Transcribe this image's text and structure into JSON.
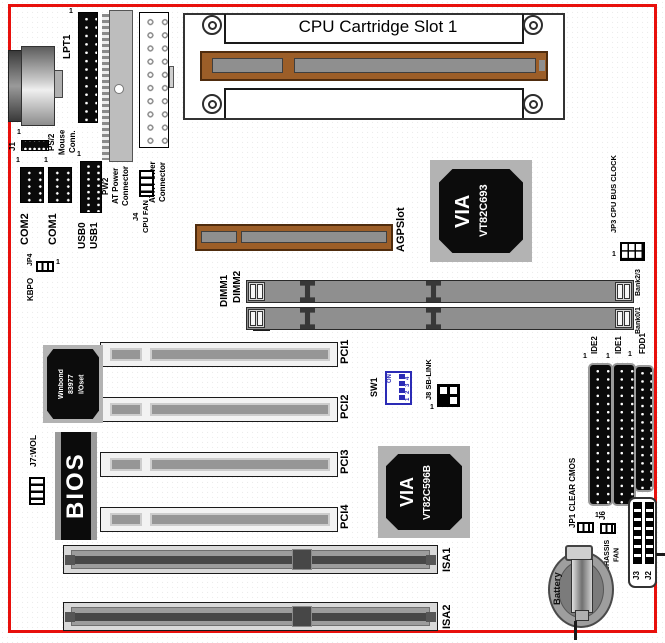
{
  "markers": {
    "pin1": "1"
  },
  "headers": {
    "j1": "J1",
    "lpt1": "LPT1",
    "ps2": "PS/2\nMouse\nConn.",
    "pw2": "PW2\nAT Power\nConnector",
    "pw1": "PW1\nATX Power\nConnector",
    "j4": "J4\nCPU FAN",
    "com2": "COM2",
    "com1": "COM1",
    "usb0": "USB0",
    "usb1": "USB1",
    "jp4": "JP4",
    "kbpo": "KBPO"
  },
  "cpu_slot": {
    "label": "CPU Cartridge Slot 1"
  },
  "agp": {
    "label": "AGPSlot"
  },
  "chips": {
    "north_bridge": {
      "brand": "VIA",
      "model": "VT82C693"
    },
    "south_bridge": {
      "brand": "VIA",
      "model": "VT82C596B"
    },
    "super_io": {
      "text": "Winbond\n83977\nI/Oset"
    },
    "bios": {
      "label": "BIOS"
    }
  },
  "jumpers": {
    "jp3": "JP3 CPU BUS CLOCK",
    "jp1": "JP1 CLEAR CMOS",
    "j6": "J6",
    "j6_sub": "CHASSIS\nFAN",
    "j7": "J7:WOL",
    "j8": "J8 SB-LINK",
    "sw1": "SW1",
    "sw1_on": "ON",
    "sw1_nums": "1 2 3 4"
  },
  "memory": {
    "dimm1": "DIMM1",
    "dimm2": "DIMM2",
    "bank01": "Bank0/1",
    "bank23": "Bank2/3"
  },
  "slots": {
    "pci": [
      "PCI1",
      "PCI2",
      "PCI3",
      "PCI4"
    ],
    "isa": [
      "ISA1",
      "ISA2"
    ]
  },
  "storage": {
    "ide2": "IDE2",
    "ide1": "IDE1",
    "fdd1": "FDD1"
  },
  "misc": {
    "battery": "Battery",
    "j3": "J3",
    "j2": "J2"
  }
}
